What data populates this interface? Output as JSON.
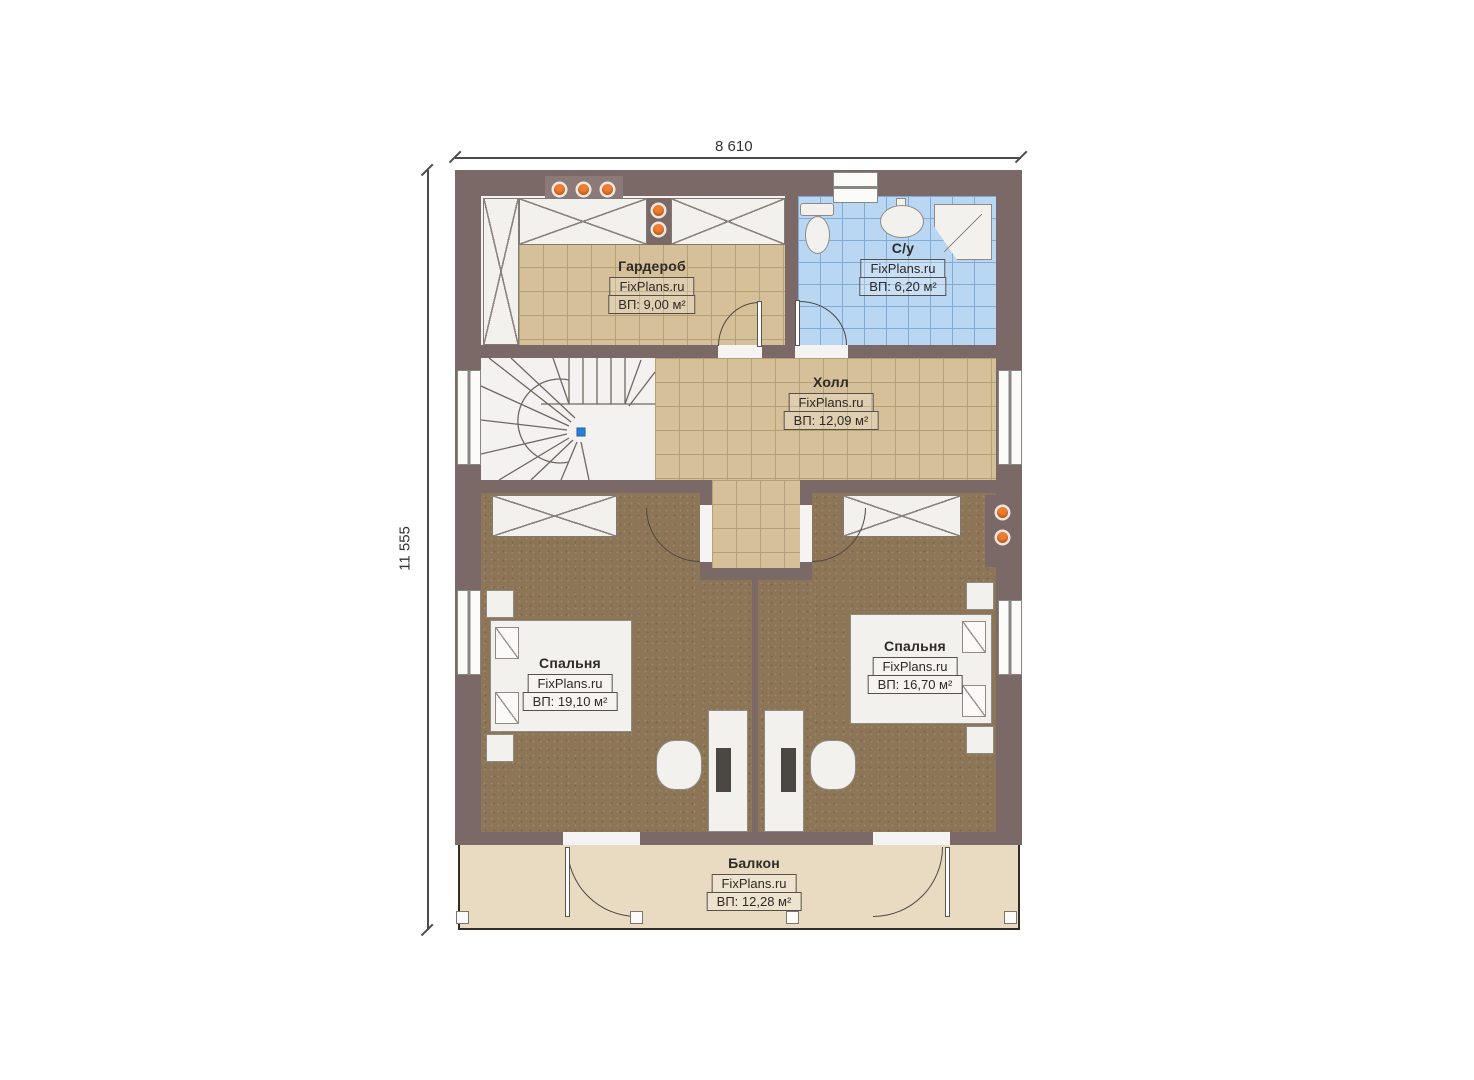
{
  "dimensions": {
    "width": "8 610",
    "height": "11 555"
  },
  "rooms": {
    "wardrobe": {
      "name": "Гардероб",
      "site": "FixPlans.ru",
      "area": "ВП: 9,00 м²"
    },
    "bathroom": {
      "name": "С/у",
      "site": "FixPlans.ru",
      "area": "ВП: 6,20 м²"
    },
    "hall": {
      "name": "Холл",
      "site": "FixPlans.ru",
      "area": "ВП: 12,09 м²"
    },
    "bedroom_left": {
      "name": "Спальня",
      "site": "FixPlans.ru",
      "area": "ВП: 19,10 м²"
    },
    "bedroom_right": {
      "name": "Спальня",
      "site": "FixPlans.ru",
      "area": "ВП: 16,70 м²"
    },
    "balcony": {
      "name": "Балкон",
      "site": "FixPlans.ru",
      "area": "ВП: 12,28 м²"
    }
  },
  "colors": {
    "wall": "#7b6968",
    "tile_tan": "#d6c099",
    "tile_blue": "#b9d6f2",
    "carpet": "#8d7557",
    "balcony_floor": "#e8dbc2",
    "heating_accent": "#ed7d31",
    "stair_marker": "#2f7fd1"
  }
}
